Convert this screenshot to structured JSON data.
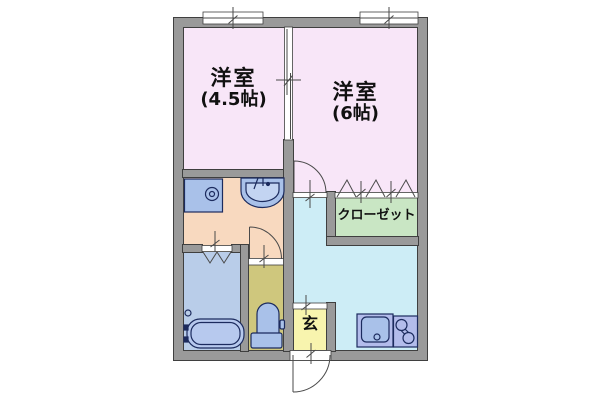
{
  "floorplan": {
    "type": "apartment-floor-plan",
    "labels": {
      "room1_name": "洋室",
      "room1_size": "(4.5帖)",
      "room2_name": "洋室",
      "room2_size": "(6帖)",
      "closet": "クローゼット",
      "entrance": "玄"
    },
    "colors": {
      "western_room": "#f8e6f8",
      "washroom": "#f8d9bf",
      "bathroom": "#b9cde9",
      "toilet_room": "#cfc77d",
      "kitchen_hall": "#cdedf6",
      "closet": "#c9e6c4",
      "entrance": "#f8f4ae",
      "wall": "#9a9a9a",
      "wall_edge": "#3f3f3f",
      "fixture_fill": "#a9c1e9",
      "fixture_stroke": "#1c2b5e",
      "counter_fill": "#b3bceb",
      "background": "#ffffff"
    },
    "fixtures": [
      "washing-machine-pan",
      "washbasin",
      "bathtub",
      "toilet",
      "kitchen-sink",
      "two-burner-stove"
    ],
    "door_symbols": [
      "window",
      "window",
      "sliding-partition",
      "room2-swing-door",
      "toilet-swing-door",
      "bathroom-folding-door",
      "closet-folding-doors",
      "entrance-swing-door"
    ]
  }
}
